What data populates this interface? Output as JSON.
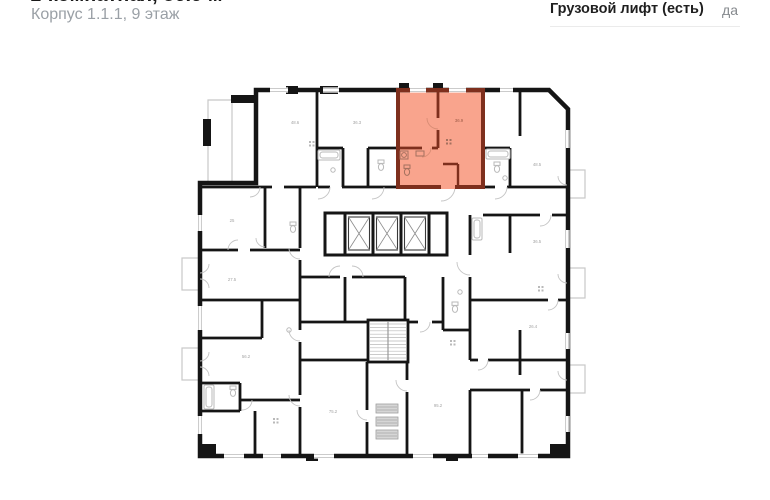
{
  "header": {
    "title": "1-комнатная, 36.9 м²",
    "subtitle": "Корпус 1.1.1, 9 этаж",
    "property_row": {
      "label": "Грузовой лифт (есть)",
      "value": "да"
    }
  },
  "plan": {
    "type": "floor-plan",
    "highlighted_apartment": "36.9",
    "colors": {
      "highlight_fill": "#F9A48D",
      "highlight_wall": "#7E2F1D",
      "wall": "#151515",
      "detail": "#C4C4C4",
      "label": "#A3A3A3",
      "highlight_label": "#9C5A46"
    },
    "elevators_count": 3,
    "room_labels": [
      {
        "text": "48.6",
        "x": 295,
        "y": 124
      },
      {
        "text": "36.3",
        "x": 357,
        "y": 124
      },
      {
        "text": "36.9",
        "x": 459,
        "y": 122,
        "hl": true
      },
      {
        "text": "48.5",
        "x": 537,
        "y": 166
      },
      {
        "text": "36.5",
        "x": 537,
        "y": 243
      },
      {
        "text": "26.4",
        "x": 533,
        "y": 328
      },
      {
        "text": "25",
        "x": 232,
        "y": 222
      },
      {
        "text": "27.5",
        "x": 232,
        "y": 281
      },
      {
        "text": "56.2",
        "x": 246,
        "y": 358
      },
      {
        "text": "75.2",
        "x": 333,
        "y": 413
      },
      {
        "text": "95.2",
        "x": 438,
        "y": 407
      }
    ]
  }
}
